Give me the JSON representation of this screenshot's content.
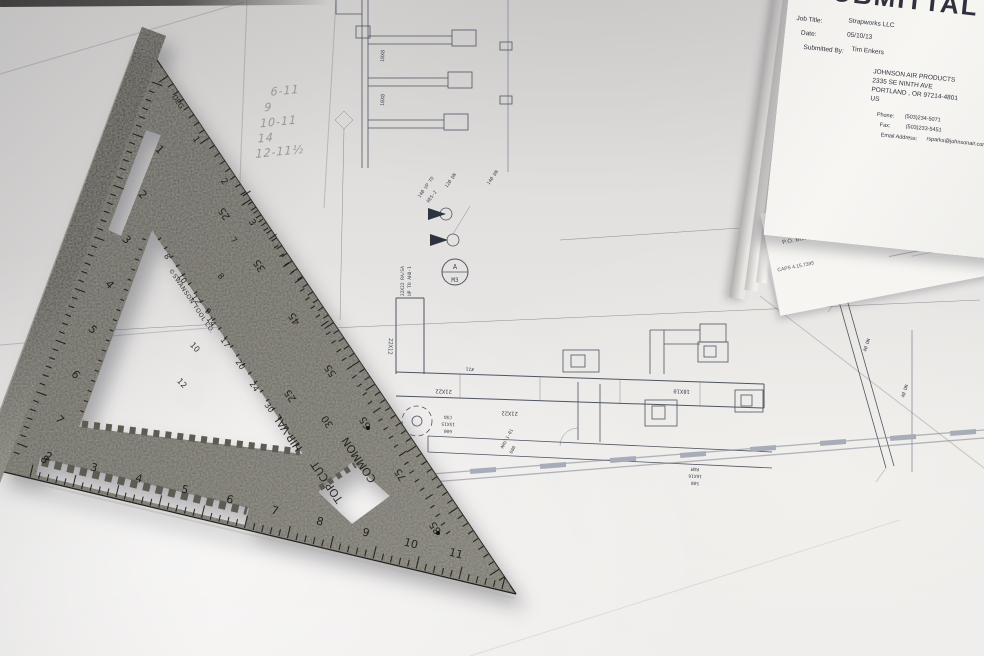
{
  "submittal": {
    "title": "SUBMITTAL",
    "fields": [
      {
        "label": "Job Title:",
        "value": "Strapworks LLC"
      },
      {
        "label": "Date:",
        "value": "05/10/13"
      },
      {
        "label": "Submitted By:",
        "value": "Tim Enkers"
      }
    ],
    "company": [
      "JOHNSON AIR PRODUCTS",
      "2335 SE NINTH AVE",
      "PORTLAND , OR  97214-4801",
      "US"
    ],
    "contact": [
      {
        "label": "Phone:",
        "value": "(503)234-5071"
      },
      {
        "label": "Fax:",
        "value": "(503)233-5451"
      },
      {
        "label": "Email Address:",
        "value": "rsparks@johnsonair.com"
      }
    ]
  },
  "greenheck": {
    "name": "GREENHECK",
    "tagline": "Building Value in Air.",
    "po_box": "P.O. Box 410",
    "city": "Schofield, WI 54476",
    "phone": "(715)359-6171",
    "fax_label": "FAX:",
    "caps_code": "CAPS 4.15.7395"
  },
  "square": {
    "brand": "©SWANSON TOOL CO.",
    "word_common": "COMMON",
    "word_hipval": "HIP-VAL",
    "word_topcut": "TOP CUT",
    "word_deg": "DEG",
    "lip_scale": [
      "1",
      "2",
      "3",
      "4",
      "5",
      "6",
      "7",
      "8"
    ],
    "hyp_inch": [
      "1",
      "2",
      "3"
    ],
    "deg_scale": [
      "25",
      "35",
      "45",
      "55",
      "65",
      "75",
      "85"
    ],
    "rafter_diag": [
      "8",
      "10",
      "12",
      "14",
      "17",
      "20",
      "24",
      "30"
    ],
    "rafter_col": [
      "7",
      "8",
      "9",
      "10",
      "12"
    ],
    "common_nums": [
      "30",
      "25"
    ],
    "bottom_scale": [
      "2",
      "3",
      "4",
      "5",
      "6",
      "7",
      "8",
      "9",
      "10",
      "11"
    ]
  },
  "blueprint": {
    "labels": {
      "trunk1": "21X22",
      "trunk2": "21X22",
      "drop": "22X12",
      "branch": "18X10",
      "tag": "#21",
      "csd": [
        "CSD",
        "15X15",
        "600"
      ],
      "ahu": [
        "AHU-1-01",
        "600"
      ],
      "rg": [
        "RG1",
        "22X22",
        "450"
      ],
      "rgm": [
        "RGM",
        "16X16",
        "500"
      ],
      "b1": "10X8",
      "b2": "10X8",
      "riser": [
        "14Ø UP TO",
        "RES-2"
      ],
      "dn12": "12Ø DN",
      "dn14": "14Ø DN",
      "ra": [
        "22X22 RA/SA",
        "UP TO AHU-1"
      ],
      "dn4a": "4Ø DN",
      "dn4b": "4Ø DN"
    },
    "callout": {
      "top": "A",
      "bottom": "M3"
    },
    "handwritten_notes": [
      "6-11",
      "9",
      "10-11",
      "14",
      "12-11½"
    ]
  }
}
